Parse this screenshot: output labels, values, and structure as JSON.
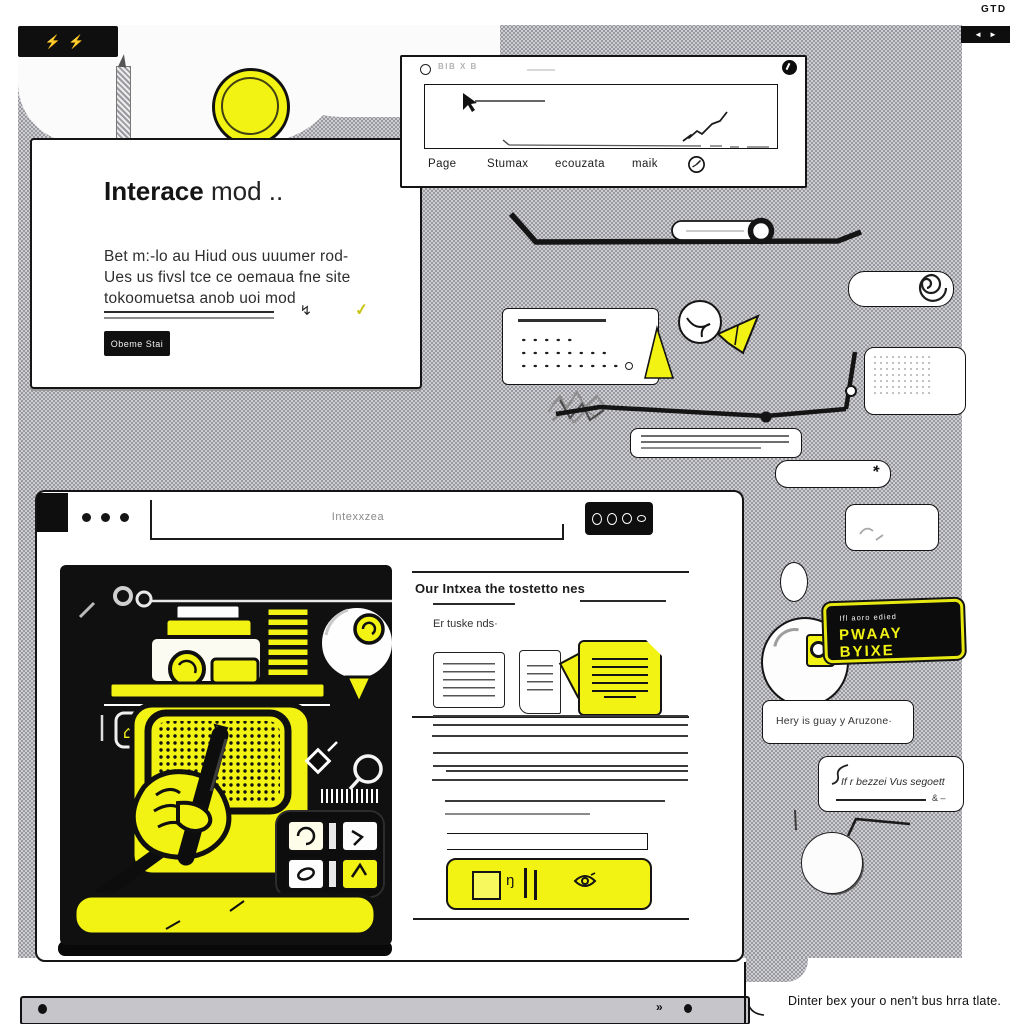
{
  "chrome": {
    "logo_marks": "⚡⚡",
    "corner_code": "GTD",
    "nav_left": "◄",
    "nav_right": "►"
  },
  "hero_card": {
    "title_bold": "Interace",
    "title_rest": "mod ..",
    "body_line1": "Bet m:-lo au Hiud ous uuumer rod-",
    "body_line2": "Ues us fivsl tce ce oemaua fne site",
    "body_line3": "tokoomuetsa anob uoi mod",
    "bolt_glyph": "↯",
    "check_glyph": "✓",
    "cta_label": "Obeme Stai"
  },
  "chart_window": {
    "header_text": "BIB X B",
    "tabs": [
      {
        "label": "Page"
      },
      {
        "label": "Stumax"
      },
      {
        "label": "ecouzata"
      },
      {
        "label": "maik"
      }
    ],
    "chart_data": {
      "type": "line",
      "x": [
        0,
        1,
        2,
        3,
        4,
        5
      ],
      "y": [
        0.3,
        0.52,
        0.46,
        0.68,
        0.76,
        0.95
      ],
      "title": "",
      "xlabel": "",
      "ylabel": ""
    }
  },
  "browser": {
    "url_text": "Intexxzea",
    "article": {
      "heading": "Our Intxea the tostetto nes",
      "subheading": "Er tuske nds·",
      "action_mark": "ŋ"
    }
  },
  "right_rail": {
    "badge_small_text": "Ifl aoro edied",
    "badge_big_text": "PWAAY BYIXE",
    "bubble_question": "Hery is guay y Aruzone·",
    "bubble_reply": "If r bezzei Vus segoett",
    "bubble_reply_suffix": "& –"
  },
  "footer": {
    "chevron": "»",
    "caption": "Dinter bex your o nen't bus hrra tlate."
  }
}
